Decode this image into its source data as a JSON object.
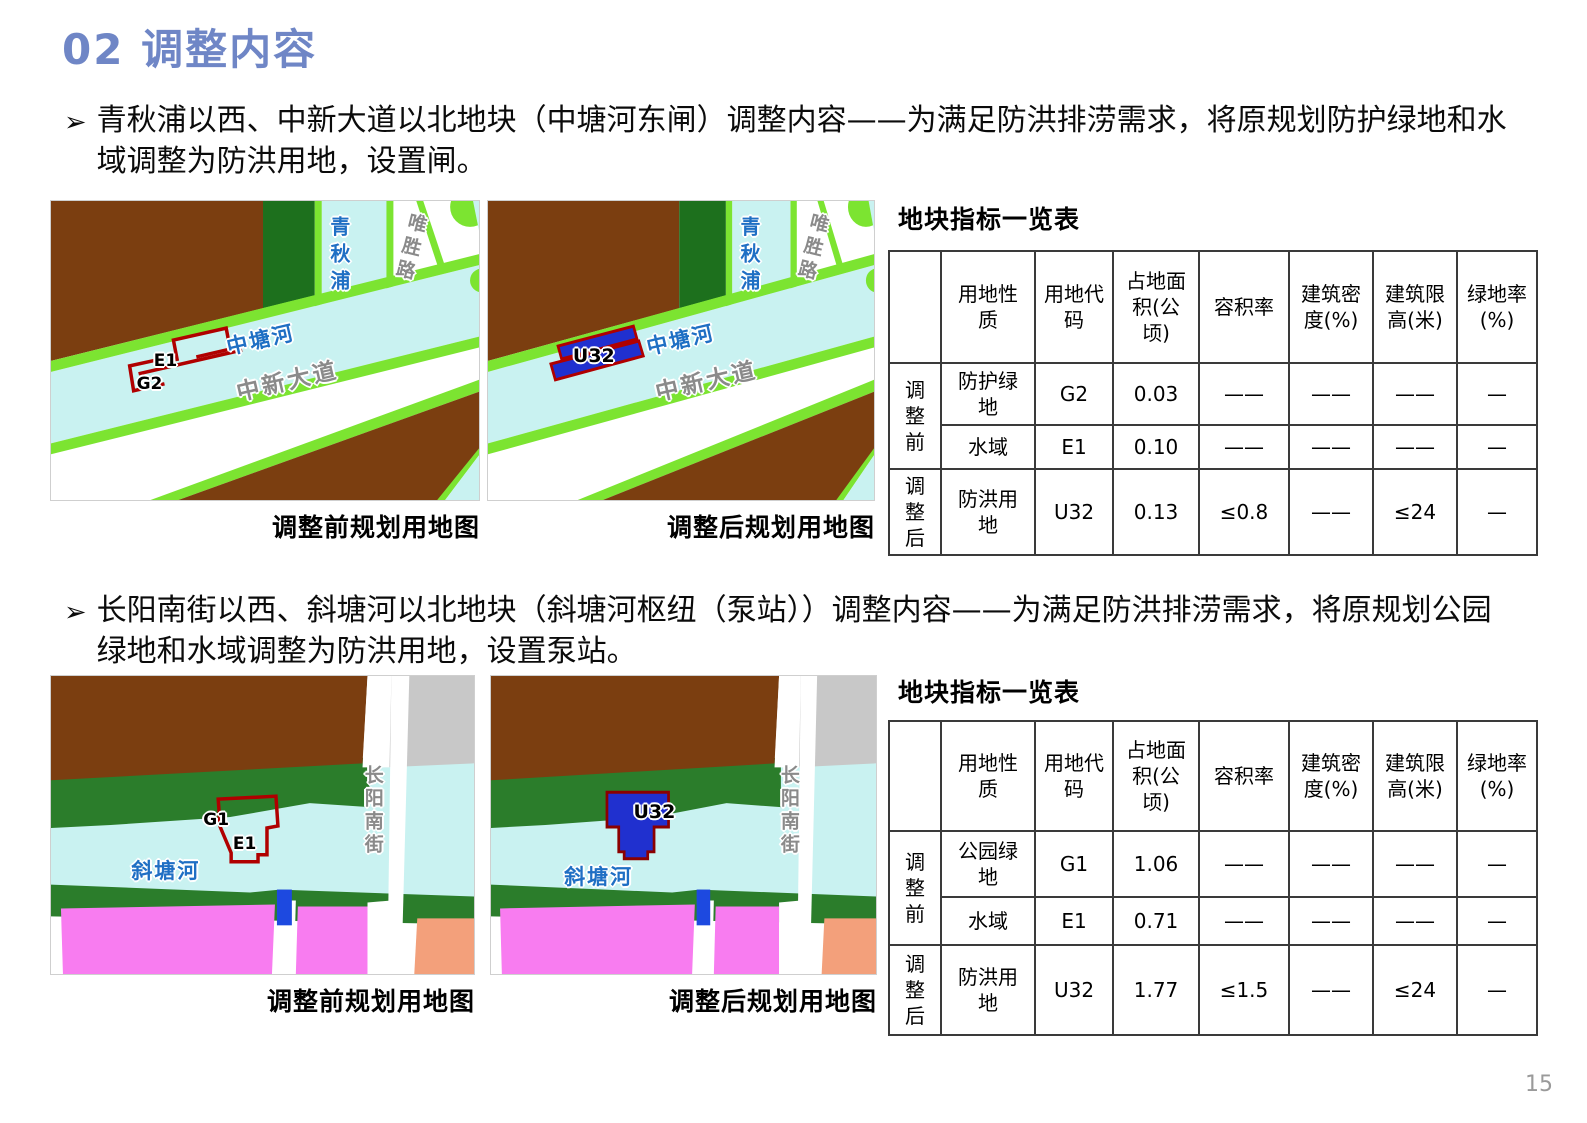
{
  "slide": {
    "title": "02 调整内容",
    "page_number": "15"
  },
  "palette": {
    "title_blue": "#6f86c6",
    "map_brown": "#7b3e10",
    "map_dark_green": "#1d701d",
    "map_forest_green": "#2b7d2b",
    "map_light_green": "#7ce431",
    "map_cyan": "#c9f2f1",
    "map_pink": "#f87cf0",
    "map_salmon": "#f3a07b",
    "map_gray": "#c8c8c8",
    "parcel_blue": "#2030cf",
    "sluice_blue": "#1d49e0",
    "parcel_outline_red": "#b00000",
    "river_label_blue": "#1f6fc4",
    "road_label_gray": "#8a8a8a"
  },
  "section1": {
    "marker": "➢",
    "bullet": "青秋浦以西、中新大道以北地块（中塘河东闸）调整内容——为满足防洪排涝需求，将原规划防护绿地和水域调整为防洪用地，设置闸。",
    "before_caption": "调整前规划用地图",
    "after_caption": "调整后规划用地图",
    "labels": {
      "qingqiupu": "青秋浦",
      "weishenglu": "唯胜路",
      "zhongtanghe": "中塘河",
      "zhongxindadao": "中新大道",
      "e1": "E1",
      "g2": "G2",
      "u32": "U32"
    },
    "table": {
      "title": "地块指标一览表",
      "headers": [
        "",
        "用地性质",
        "用地代码",
        "占地面积(公顷)",
        "容积率",
        "建筑密度(%)",
        "建筑限高(米)",
        "绿地率(%)"
      ],
      "groups": [
        {
          "label": "调整前",
          "rows": [
            [
              "防护绿地",
              "G2",
              "0.03",
              "——",
              "——",
              "——",
              "—"
            ],
            [
              "水域",
              "E1",
              "0.10",
              "——",
              "——",
              "——",
              "—"
            ]
          ]
        },
        {
          "label": "调整后",
          "rows": [
            [
              "防洪用地",
              "U32",
              "0.13",
              "≤0.8",
              "——",
              "≤24",
              "—"
            ]
          ]
        }
      ]
    }
  },
  "section2": {
    "marker": "➢",
    "bullet": "长阳南街以西、斜塘河以北地块（斜塘河枢纽（泵站））调整内容——为满足防洪排涝需求，将原规划公园绿地和水域调整为防洪用地，设置泵站。",
    "before_caption": "调整前规划用地图",
    "after_caption": "调整后规划用地图",
    "labels": {
      "changyangnanjie": "长阳南街",
      "xietanghe": "斜塘河",
      "g1": "G1",
      "e1": "E1",
      "u32": "U32"
    },
    "table": {
      "title": "地块指标一览表",
      "headers": [
        "",
        "用地性质",
        "用地代码",
        "占地面积(公顷)",
        "容积率",
        "建筑密度(%)",
        "建筑限高(米)",
        "绿地率(%)"
      ],
      "groups": [
        {
          "label": "调整前",
          "rows": [
            [
              "公园绿地",
              "G1",
              "1.06",
              "——",
              "——",
              "——",
              "—"
            ],
            [
              "水域",
              "E1",
              "0.71",
              "——",
              "——",
              "——",
              "—"
            ]
          ]
        },
        {
          "label": "调整后",
          "rows": [
            [
              "防洪用地",
              "U32",
              "1.77",
              "≤1.5",
              "——",
              "≤24",
              "—"
            ]
          ]
        }
      ]
    }
  }
}
